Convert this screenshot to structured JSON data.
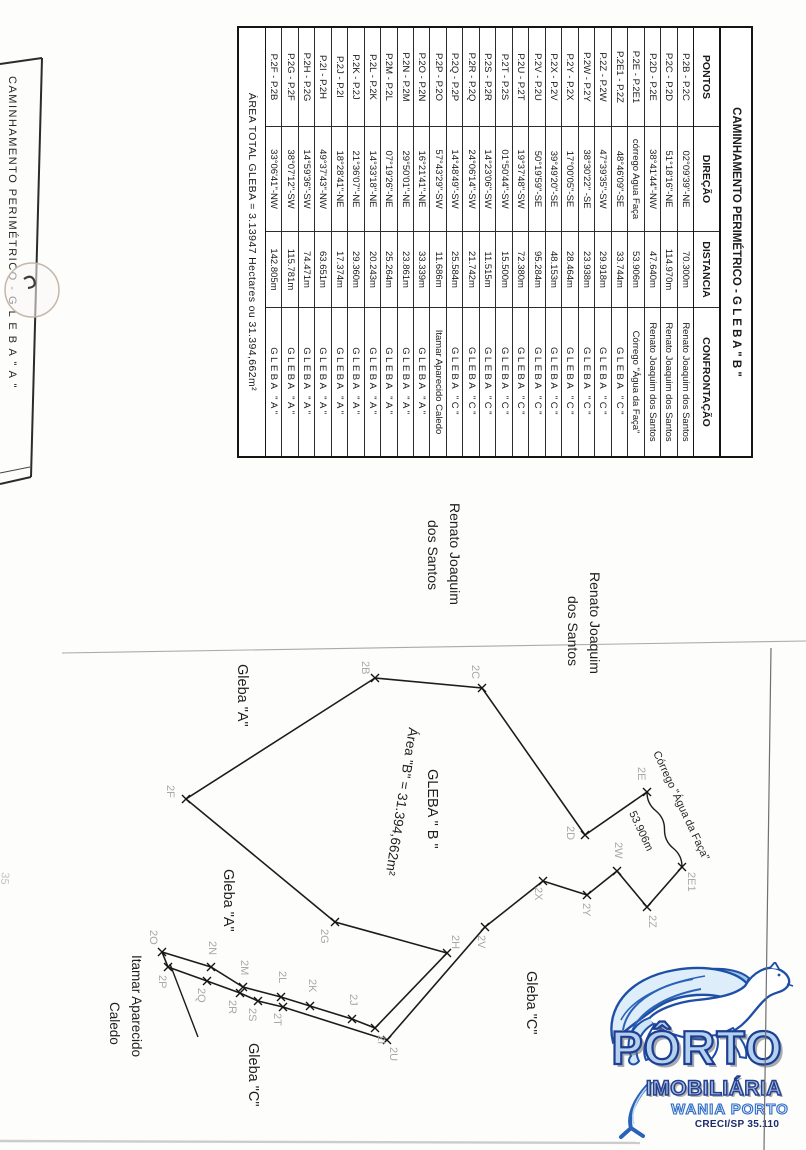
{
  "table": {
    "title": "CAMINHAMENTO PERIMÉTRICO - G L E B A \" B \"",
    "columns": [
      "PONTOS",
      "DIREÇÃO",
      "DISTANCIA",
      "CONFRONTAÇÃO"
    ],
    "rows": [
      [
        "P.2B - P.2C",
        "02°09'39\"-NE",
        "70.300m",
        "Renato Joaquim dos Santos"
      ],
      [
        "P.2C - P.2D",
        "51°18'16\"-NE",
        "114.970m",
        "Renato Joaquim dos Santos"
      ],
      [
        "P.2D - P.2E",
        "38°41'44\"-NW",
        "47.640m",
        "Renato Joaquim dos Santos"
      ],
      [
        "P.2E - P.2E1",
        "córrego Agua Faça",
        "53.906m",
        "Córrego \"Água da Faça\""
      ],
      [
        "P.2E1 - P.2Z",
        "48°46'09\"-SE",
        "33.744m",
        "GLEBA \"C\""
      ],
      [
        "P.2Z - P.2W",
        "47°39'35\"-SW",
        "29.918m",
        "GLEBA \"C\""
      ],
      [
        "P.2W - P.2Y",
        "38°30'22\" -SE",
        "23.938m",
        "GLEBA \"C\""
      ],
      [
        "P.2Y - P.2X",
        "17°00'05\"-SE",
        "28.464m",
        "GLEBA \"C\""
      ],
      [
        "P.2X - P.2V",
        "39°49'20\"-SE",
        "48.153m",
        "GLEBA \"C\""
      ],
      [
        "P.2V - P.2U",
        "50°19'59\"-SE",
        "95.284m",
        "GLEBA \"C\""
      ],
      [
        "P.2U - P.2T",
        "19°37'48\"-SW",
        "72.380m",
        "GLEBA \"C\""
      ],
      [
        "P.2T - P.2S",
        "01°50'44\"-SW",
        "15.500m",
        "GLEBA \"C\""
      ],
      [
        "P.2S - P.2R",
        "14°23'06\"-SW",
        "11.515m",
        "GLEBA \"C\""
      ],
      [
        "P.2R - P.2Q",
        "24°06'14\"-SW",
        "21.742m",
        "GLEBA \"C\""
      ],
      [
        "P.2Q - P.2P",
        "14°48'49\"-SW",
        "25.584m",
        "GLEBA \"C\""
      ],
      [
        "P.2P - P.2O",
        "57°43'29\"-SW",
        "11.686m",
        "Itamar Aparecido Caledo"
      ],
      [
        "P.2O - P.2N",
        "16°21'41\"-NE",
        "33.339m",
        "GLEBA \"A\""
      ],
      [
        "P.2N - P.2M",
        "29°50'01\"-NE",
        "23.861m",
        "GLEBA \"A\""
      ],
      [
        "P.2M - P.2L",
        "07°19'26\"-NE",
        "25.264m",
        "GLEBA \"A\""
      ],
      [
        "P.2L - P.2K",
        "14°33'18\"-NE",
        "20.243m",
        "GLEBA \"A\""
      ],
      [
        "P.2K - P.2J",
        "21°36'07\"-NE",
        "29.360m",
        "GLEBA \"A\""
      ],
      [
        "P.2J - P.2I",
        "18°28'41\"-NE",
        "17.374m",
        "GLEBA \"A\""
      ],
      [
        "P.2I - P.2H",
        "49°37'43\"-NW",
        "63.651m",
        "GLEBA \"A\""
      ],
      [
        "P.2H - P.2G",
        "14°59'36\"-SW",
        "74.471m",
        "GLEBA \"A\""
      ],
      [
        "P.2G - P.2F",
        "38°07'12\"-SW",
        "115.781m",
        "GLEBA \"A\""
      ],
      [
        "P.2F - P.2B",
        "33°06'41\"-NW",
        "142.805m",
        "GLEBA \"A\""
      ]
    ],
    "footer": "ÁREA TOTAL GLEBA = 3.13947 Hectares ou 31.394,662m²"
  },
  "left_strip": {
    "title": "CAMINHAMENTO PERIMÉTRICO - G L E B A \" A \""
  },
  "handwriting": "35",
  "map": {
    "vertices": [
      {
        "id": "2B",
        "x": 375,
        "y": 678,
        "lx": 362,
        "ly": 661
      },
      {
        "id": "2C",
        "x": 482,
        "y": 688,
        "lx": 472,
        "ly": 665
      },
      {
        "id": "2D",
        "x": 585,
        "y": 835,
        "lx": 567,
        "ly": 826
      },
      {
        "id": "2E",
        "x": 647,
        "y": 792,
        "lx": 638,
        "ly": 767
      },
      {
        "id": "2E1",
        "x": 682,
        "y": 867,
        "lx": 688,
        "ly": 872
      },
      {
        "id": "2Z",
        "x": 647,
        "y": 907,
        "lx": 649,
        "ly": 915
      },
      {
        "id": "2W",
        "x": 617,
        "y": 871,
        "lx": 615,
        "ly": 842
      },
      {
        "id": "2Y",
        "x": 587,
        "y": 895,
        "lx": 583,
        "ly": 903
      },
      {
        "id": "2X",
        "x": 543,
        "y": 881,
        "lx": 535,
        "ly": 887
      },
      {
        "id": "2V",
        "x": 485,
        "y": 927,
        "lx": 478,
        "ly": 935
      },
      {
        "id": "2U",
        "x": 387,
        "y": 1040,
        "lx": 390,
        "ly": 1047
      },
      {
        "id": "2T",
        "x": 283,
        "y": 1007,
        "lx": 274,
        "ly": 1013
      },
      {
        "id": "2S",
        "x": 258,
        "y": 1001,
        "lx": 249,
        "ly": 1008
      },
      {
        "id": "2R",
        "x": 240,
        "y": 993,
        "lx": 229,
        "ly": 1000
      },
      {
        "id": "2Q",
        "x": 207,
        "y": 981,
        "lx": 198,
        "ly": 988
      },
      {
        "id": "2P",
        "x": 168,
        "y": 967,
        "lx": 159,
        "ly": 975
      },
      {
        "id": "2O",
        "x": 162,
        "y": 952,
        "lx": 150,
        "ly": 930
      },
      {
        "id": "2N",
        "x": 211,
        "y": 967,
        "lx": 209,
        "ly": 941
      },
      {
        "id": "2M",
        "x": 243,
        "y": 987,
        "lx": 241,
        "ly": 960
      },
      {
        "id": "2L",
        "x": 281,
        "y": 997,
        "lx": 279,
        "ly": 971
      },
      {
        "id": "2K",
        "x": 310,
        "y": 1006,
        "lx": 309,
        "ly": 979
      },
      {
        "id": "2J",
        "x": 352,
        "y": 1019,
        "lx": 350,
        "ly": 994
      },
      {
        "id": "2I",
        "x": 375,
        "y": 1028,
        "lx": 378,
        "ly": 1035
      },
      {
        "id": "2H",
        "x": 447,
        "y": 953,
        "lx": 452,
        "ly": 935
      },
      {
        "id": "2G",
        "x": 335,
        "y": 922,
        "lx": 321,
        "ly": 929
      },
      {
        "id": "2F",
        "x": 186,
        "y": 799,
        "lx": 167,
        "ly": 785
      }
    ],
    "outline_before_stream": [
      "2B",
      "2C",
      "2D",
      "2E"
    ],
    "outline_after_stream": [
      "2E1",
      "2Z",
      "2W",
      "2Y",
      "2X",
      "2V",
      "2U",
      "2T",
      "2S",
      "2R",
      "2Q",
      "2P",
      "2O",
      "2N",
      "2M",
      "2L",
      "2K",
      "2J",
      "2I",
      "2H",
      "2G",
      "2F",
      "2B"
    ],
    "stream": {
      "from": "2E",
      "to": "2E1"
    },
    "extra_line": {
      "x1": 170,
      "y1": 964,
      "x2": 198,
      "y2": 1037
    },
    "labels": [
      {
        "text": "Renato Joaquim",
        "x": 450,
        "y": 503,
        "size": 14,
        "angle": 90,
        "color": "#1f1f1f"
      },
      {
        "text": "dos Santos",
        "x": 428,
        "y": 520,
        "size": 14,
        "angle": 90,
        "color": "#1f1f1f"
      },
      {
        "text": "Renato Joaquim",
        "x": 590,
        "y": 572,
        "size": 14,
        "angle": 90,
        "color": "#1f1f1f"
      },
      {
        "text": "dos Santos",
        "x": 568,
        "y": 596,
        "size": 14,
        "angle": 90,
        "color": "#1f1f1f"
      },
      {
        "text": "Gleba \"A\"",
        "x": 238,
        "y": 664,
        "size": 14.5,
        "angle": 90,
        "color": "#1f1f1f"
      },
      {
        "text": "Gleba \"A\"",
        "x": 224,
        "y": 869,
        "size": 14.5,
        "angle": 90,
        "color": "#1f1f1f"
      },
      {
        "text": "Área \"B\" = 31.394,662m²",
        "x": 409,
        "y": 727,
        "size": 13.5,
        "angle": 99,
        "color": "#1f1f1f"
      },
      {
        "text": "GLEBA \" B \"",
        "x": 428,
        "y": 769,
        "size": 14.5,
        "angle": 90,
        "color": "#1f1f1f"
      },
      {
        "text": "Córrego \"Água da Faça\"",
        "x": 653,
        "y": 753,
        "size": 11,
        "angle": 65,
        "color": "#2a2a2a"
      },
      {
        "text": "53.906m",
        "x": 629,
        "y": 813,
        "size": 11,
        "angle": 65,
        "color": "#2a2a2a"
      },
      {
        "text": "Gleba \"C\"",
        "x": 527,
        "y": 971,
        "size": 14.5,
        "angle": 90,
        "color": "#1f1f1f"
      },
      {
        "text": "Gleba \"C\"",
        "x": 249,
        "y": 1043,
        "size": 14.5,
        "angle": 90,
        "color": "#1f1f1f"
      },
      {
        "text": "Itamar Aparecido",
        "x": 132,
        "y": 955,
        "size": 13.5,
        "angle": 90,
        "color": "#1f1f1f"
      },
      {
        "text": "Caledo",
        "x": 110,
        "y": 1002,
        "size": 13.5,
        "angle": 90,
        "color": "#1f1f1f"
      }
    ]
  },
  "logo": {
    "name": "PÔRTO",
    "line2": "IMOBILIÁRIA",
    "line3": "WANIA PORTO",
    "line4": "CRECI/SP 35.110"
  }
}
